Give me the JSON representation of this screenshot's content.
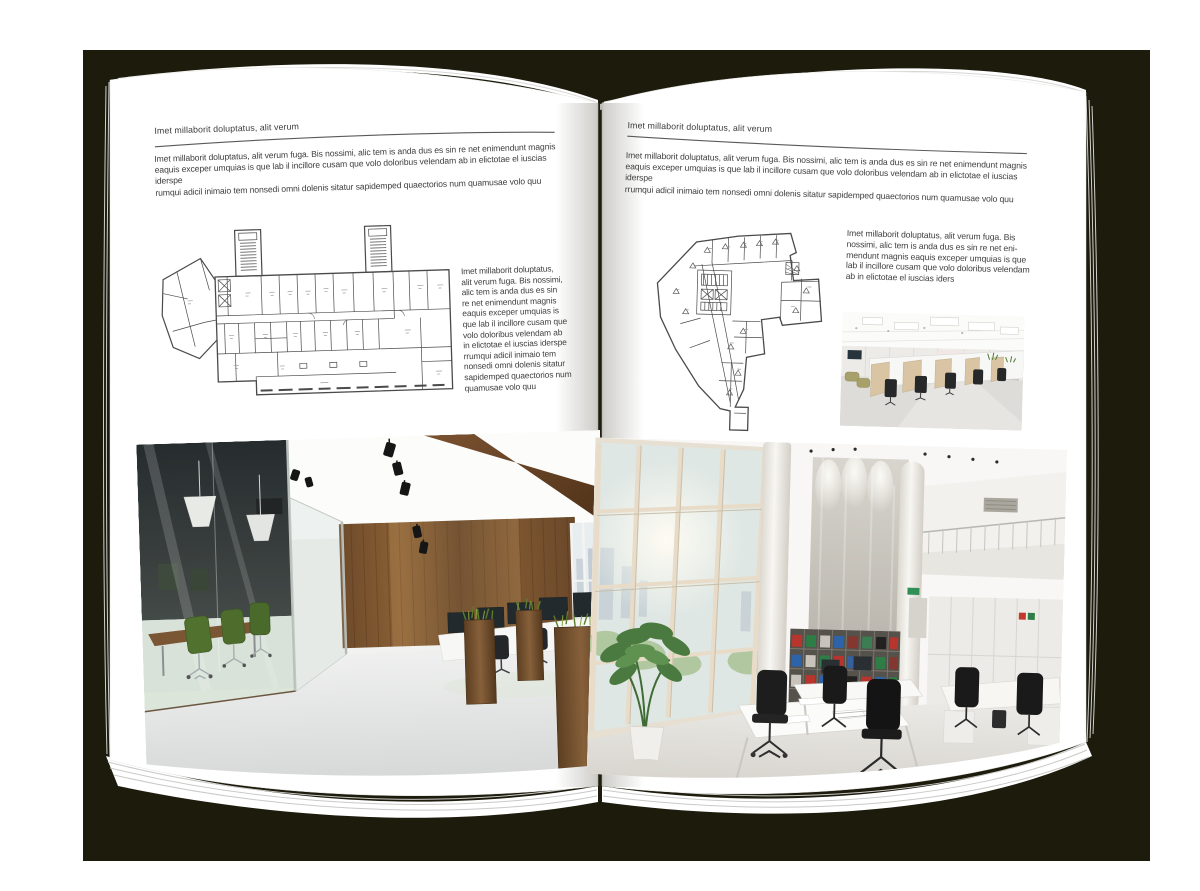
{
  "book": {
    "page_left": {
      "header": "Imet millaborit doluptatus, alit verum",
      "intro": "Imet millaborit doluptatus, alit verum fuga. Bis nossimi, alic tem is anda dus es sin re net enimendunt magnis\neaquis exceper umquias is que lab il incillore cusam que volo doloribus velendam ab in elictotae el iuscias iderspe\nrumqui adicil inimaio tem nonsedi omni dolenis sitatur sapidemped quaectorios num quamusae volo quu",
      "side_text": "Imet millaborit doluptatus,\nalit verum fuga. Bis nossimi,\nalic tem is anda dus es sin\nre net enimendunt magnis\neaquis exceper umquias is\nque lab il incillore cusam que\nvolo doloribus velendam ab\nin elictotae el iuscias iderspe\nrrumqui adicil inimaio tem\nnonsedi omni dolenis sitatur\nsapidemped quaectorios num\nquamusae volo quu"
    },
    "page_right": {
      "header": "Imet millaborit doluptatus, alit verum",
      "intro": "Imet millaborit doluptatus, alit verum fuga. Bis nossimi, alic tem is anda dus es sin re net enimendunt magnis\neaquis exceper umquias is que lab il incillore cusam que volo doloribus velendam ab in elictotae el iuscias iderspe\nrrumqui adicil inimaio tem nonsedi omni dolenis sitatur sapidemped quaectorios num quamusae volo quu",
      "side_text": "Imet millaborit doluptatus, alit verum fuga. Bis\nnossimi, alic tem is anda dus es sin re net eni-\nmendunt magnis eaquis exceper umquias is que\nlab il incillore cusam que volo doloribus velendam\nab in elictotae el iuscias iders"
    },
    "colors": {
      "backdrop": "#1d1b0c",
      "page": "#ffffff",
      "text": "#3d3d3d",
      "plan_line": "#4a4a4a",
      "wood": "#7a5230",
      "chair_green": "#51712f",
      "binder_red": "#b7352c",
      "binder_green": "#2e7d46",
      "binder_blue": "#2d63a8"
    }
  }
}
